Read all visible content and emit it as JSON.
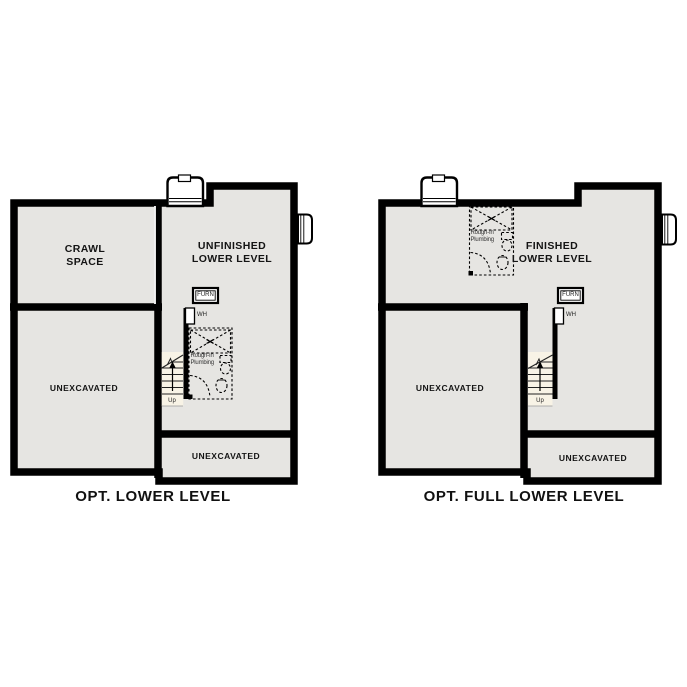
{
  "colors": {
    "wall": "#000000",
    "floor": "#e6e5e2",
    "stair_fill": "#f8f3e6",
    "background": "#ffffff",
    "text": "#141414"
  },
  "plans": [
    {
      "id": "opt-lower-level",
      "caption": "OPT. LOWER LEVEL",
      "rooms": {
        "crawl_space": "CRAWL\nSPACE",
        "main": "UNFINISHED\nLOWER LEVEL",
        "unexcavated_large": "UNEXCAVATED",
        "unexcavated_small": "UNEXCAVATED"
      },
      "fixtures": {
        "furnace": "FURN",
        "water_heater": "WH",
        "stairs": "Up",
        "plumbing": "Rough-In\nPlumbing"
      }
    },
    {
      "id": "opt-full-lower-level",
      "caption": "OPT. FULL LOWER LEVEL",
      "rooms": {
        "main": "FINISHED\nLOWER LEVEL",
        "unexcavated_large": "UNEXCAVATED",
        "unexcavated_small": "UNEXCAVATED"
      },
      "fixtures": {
        "furnace": "FURN",
        "water_heater": "WH",
        "stairs": "Up",
        "plumbing": "Rough-In\nPlumbing"
      }
    }
  ]
}
